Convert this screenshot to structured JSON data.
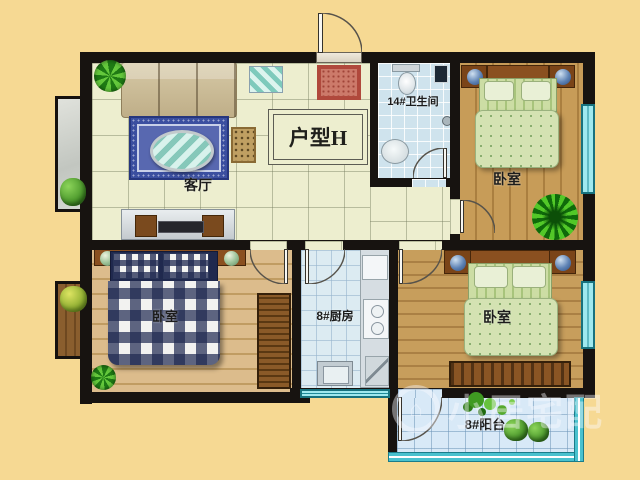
{
  "plan": {
    "unit_label": "户型H",
    "rooms": {
      "living": {
        "label": "客厅"
      },
      "bathroom": {
        "label": "14#卫生间"
      },
      "bedroom_tr": {
        "label": "卧室"
      },
      "bedroom_bl": {
        "label": "卧室"
      },
      "kitchen": {
        "label": "8#厨房"
      },
      "bedroom_br": {
        "label": "卧室"
      },
      "balcony": {
        "label": "8#阳台"
      }
    }
  },
  "watermark": {
    "text": "小居宅配",
    "logo_glyph": "⌂"
  },
  "colors": {
    "background": "#f6d993",
    "wall": "#171310",
    "tile_floor": "#edeecf",
    "wood_floor": "#c79c58",
    "bath_floor": "#cfe3ed",
    "balcony_floor": "#d8e9f7",
    "window_teal": "#49c1ce",
    "rug_blue": "#3b4fa0",
    "bed_check_navy": "#20294e",
    "bed_green": "#d4e2b2",
    "doormat_red": "#b0493c"
  }
}
